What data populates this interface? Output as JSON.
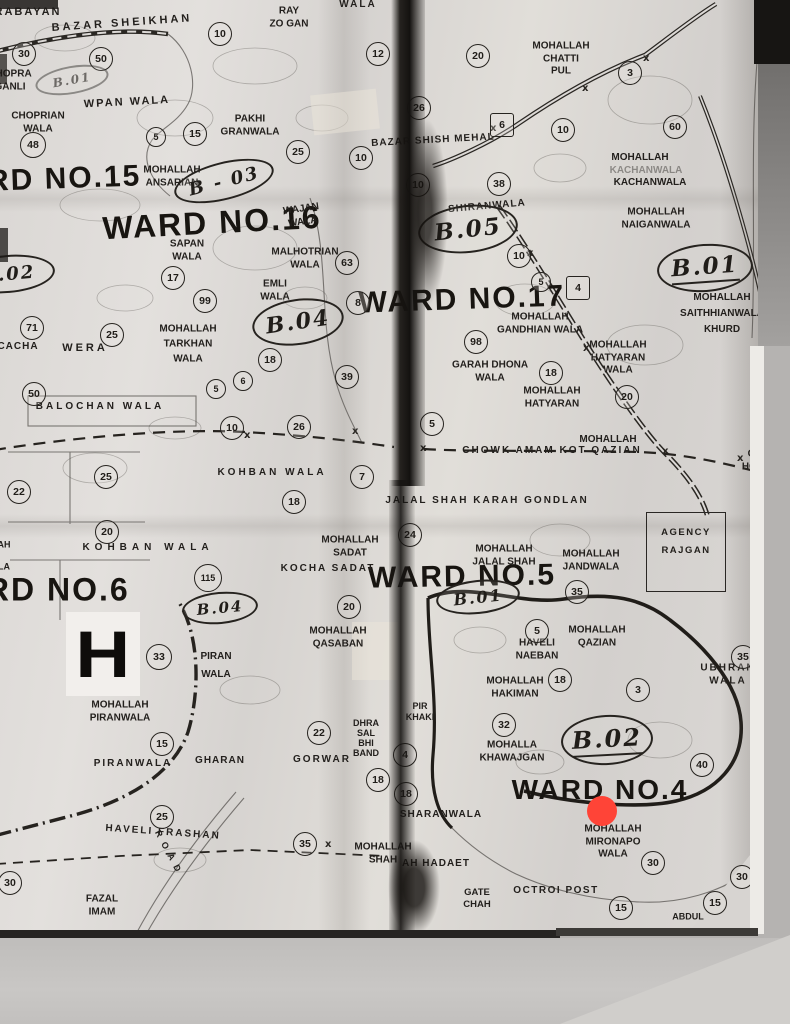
{
  "map": {
    "colors": {
      "ink": "#221f1c",
      "paper": "#dcd9d6",
      "red_dot": "#ff4437",
      "strip": "#141210"
    },
    "ward_titles": [
      {
        "text": "WARD NO.15",
        "x": 38,
        "y": 180,
        "size": 30,
        "rot": -2
      },
      {
        "text": "WARD NO.16",
        "x": 212,
        "y": 223,
        "size": 32,
        "rot": -3
      },
      {
        "text": "WARD NO.17",
        "x": 462,
        "y": 300,
        "size": 30,
        "rot": -2
      },
      {
        "text": "WARD NO.6",
        "x": 30,
        "y": 590,
        "size": 32,
        "rot": 0
      },
      {
        "text": "WARD NO.5",
        "x": 462,
        "y": 577,
        "size": 30,
        "rot": -1
      },
      {
        "text": "WARD NO.4",
        "x": 600,
        "y": 790,
        "size": 28,
        "rot": 0
      }
    ],
    "block_codes": [
      {
        "text": "B - 03",
        "x": 224,
        "y": 181,
        "w": 98,
        "h": 34,
        "rot": -14
      },
      {
        "text": "B.02",
        "x": 8,
        "y": 274,
        "w": 90,
        "h": 34,
        "rot": -5
      },
      {
        "text": "B.04",
        "x": 298,
        "y": 322,
        "w": 88,
        "h": 42,
        "rot": -8
      },
      {
        "text": "B.05",
        "x": 468,
        "y": 229,
        "w": 96,
        "h": 44,
        "rot": -6
      },
      {
        "text": "B.01",
        "x": 705,
        "y": 268,
        "w": 92,
        "h": 44,
        "rot": -4,
        "ul": true
      },
      {
        "text": "B.01",
        "x": 478,
        "y": 597,
        "w": 80,
        "h": 30,
        "rot": -6
      },
      {
        "text": "B.04",
        "x": 220,
        "y": 608,
        "w": 72,
        "h": 28,
        "rot": -5
      },
      {
        "text": "B.02",
        "x": 607,
        "y": 740,
        "w": 88,
        "h": 46,
        "rot": -3,
        "ul": true
      },
      {
        "text": "B.01",
        "x": 72,
        "y": 80,
        "w": 70,
        "h": 24,
        "rot": -10,
        "faint": true
      }
    ],
    "number_circles": [
      {
        "n": "30",
        "x": 24,
        "y": 54
      },
      {
        "n": "50",
        "x": 101,
        "y": 59
      },
      {
        "n": "10",
        "x": 220,
        "y": 34
      },
      {
        "n": "12",
        "x": 378,
        "y": 54
      },
      {
        "n": "5",
        "x": 156,
        "y": 137,
        "d": 18
      },
      {
        "n": "15",
        "x": 195,
        "y": 134
      },
      {
        "n": "25",
        "x": 298,
        "y": 152
      },
      {
        "n": "10",
        "x": 361,
        "y": 158
      },
      {
        "n": "48",
        "x": 33,
        "y": 145,
        "d": 24
      },
      {
        "n": "20",
        "x": 478,
        "y": 56
      },
      {
        "n": "3",
        "x": 630,
        "y": 73
      },
      {
        "n": "26",
        "x": 419,
        "y": 108
      },
      {
        "n": "6",
        "x": 502,
        "y": 125,
        "shape": "square"
      },
      {
        "n": "10",
        "x": 563,
        "y": 130
      },
      {
        "n": "60",
        "x": 675,
        "y": 127
      },
      {
        "n": "10",
        "x": 418,
        "y": 185
      },
      {
        "n": "38",
        "x": 499,
        "y": 184
      },
      {
        "n": "17",
        "x": 173,
        "y": 278
      },
      {
        "n": "63",
        "x": 347,
        "y": 263
      },
      {
        "n": "99",
        "x": 205,
        "y": 301
      },
      {
        "n": "8",
        "x": 358,
        "y": 303
      },
      {
        "n": "71",
        "x": 32,
        "y": 328
      },
      {
        "n": "25",
        "x": 112,
        "y": 335
      },
      {
        "n": "18",
        "x": 270,
        "y": 360
      },
      {
        "n": "6",
        "x": 243,
        "y": 381,
        "d": 18
      },
      {
        "n": "5",
        "x": 216,
        "y": 389,
        "d": 18
      },
      {
        "n": "39",
        "x": 347,
        "y": 377
      },
      {
        "n": "50",
        "x": 34,
        "y": 394
      },
      {
        "n": "10",
        "x": 519,
        "y": 256
      },
      {
        "n": "5",
        "x": 541,
        "y": 282,
        "d": 18
      },
      {
        "n": "4",
        "x": 578,
        "y": 288,
        "shape": "square"
      },
      {
        "n": "98",
        "x": 476,
        "y": 342
      },
      {
        "n": "18",
        "x": 551,
        "y": 373
      },
      {
        "n": "20",
        "x": 627,
        "y": 397
      },
      {
        "n": "10",
        "x": 232,
        "y": 428
      },
      {
        "n": "26",
        "x": 299,
        "y": 427
      },
      {
        "n": "25",
        "x": 106,
        "y": 477
      },
      {
        "n": "22",
        "x": 19,
        "y": 492
      },
      {
        "n": "7",
        "x": 362,
        "y": 477
      },
      {
        "n": "18",
        "x": 294,
        "y": 502
      },
      {
        "n": "20",
        "x": 107,
        "y": 532
      },
      {
        "n": "115",
        "x": 208,
        "y": 578,
        "d": 26
      },
      {
        "n": "5",
        "x": 432,
        "y": 424
      },
      {
        "n": "24",
        "x": 410,
        "y": 535
      },
      {
        "n": "35",
        "x": 577,
        "y": 592
      },
      {
        "n": "20",
        "x": 349,
        "y": 607
      },
      {
        "n": "33",
        "x": 159,
        "y": 657,
        "d": 24
      },
      {
        "n": "22",
        "x": 319,
        "y": 733
      },
      {
        "n": "15",
        "x": 162,
        "y": 744
      },
      {
        "n": "18",
        "x": 378,
        "y": 780
      },
      {
        "n": "5",
        "x": 537,
        "y": 631
      },
      {
        "n": "18",
        "x": 560,
        "y": 680
      },
      {
        "n": "3",
        "x": 638,
        "y": 690
      },
      {
        "n": "35",
        "x": 743,
        "y": 657
      },
      {
        "n": "32",
        "x": 504,
        "y": 725
      },
      {
        "n": "40",
        "x": 702,
        "y": 765
      },
      {
        "n": "4",
        "x": 405,
        "y": 755
      },
      {
        "n": "18",
        "x": 406,
        "y": 794
      },
      {
        "n": "25",
        "x": 162,
        "y": 817
      },
      {
        "n": "35",
        "x": 305,
        "y": 844
      },
      {
        "n": "30",
        "x": 10,
        "y": 883
      },
      {
        "n": "30",
        "x": 653,
        "y": 863
      },
      {
        "n": "30",
        "x": 742,
        "y": 877
      },
      {
        "n": "15",
        "x": 621,
        "y": 908
      },
      {
        "n": "15",
        "x": 715,
        "y": 903
      }
    ],
    "labels": [
      {
        "text": "RABAYAN",
        "x": 28,
        "y": 13,
        "size": 11,
        "sp": 2
      },
      {
        "text": "BAZAR SHEIKHAN",
        "x": 122,
        "y": 24,
        "size": 11,
        "sp": 3,
        "rot": -4
      },
      {
        "text": "RAY\nZO GAN",
        "x": 289,
        "y": 18
      },
      {
        "text": "WALA",
        "x": 358,
        "y": 5,
        "sp": 2
      },
      {
        "text": "CHOPRA\nGANLI",
        "x": 10,
        "y": 81
      },
      {
        "text": "WPAN WALA",
        "x": 127,
        "y": 103,
        "size": 11,
        "sp": 2,
        "rot": -3
      },
      {
        "text": "CHOPRIAN\nWALA",
        "x": 38,
        "y": 123
      },
      {
        "text": "PAKHI\nGRANWALA",
        "x": 250,
        "y": 126
      },
      {
        "text": "MOHALLAH\nANSARIAN",
        "x": 172,
        "y": 177
      },
      {
        "text": "MOHALLAH\nCHATTI\nPUL",
        "x": 561,
        "y": 59
      },
      {
        "text": "BAZAR SHISH MEHAL",
        "x": 433,
        "y": 141,
        "sp": 1,
        "rot": -3
      },
      {
        "text": "MOHALLAH",
        "x": 640,
        "y": 158
      },
      {
        "text": "KACHANWALA",
        "x": 646,
        "y": 171,
        "faded": true
      },
      {
        "text": "KACHANWALA",
        "x": 650,
        "y": 183
      },
      {
        "text": "MOHALLAH\nNAIGANWALA",
        "x": 656,
        "y": 219
      },
      {
        "text": "SHIRANWALA",
        "x": 487,
        "y": 207,
        "rot": -5,
        "sp": 1
      },
      {
        "text": "WAJAN\nWALA",
        "x": 302,
        "y": 216,
        "rot": -8
      },
      {
        "text": "SAPAN\nWALA",
        "x": 187,
        "y": 251
      },
      {
        "text": "MALHOTRIAN\nWALA",
        "x": 305,
        "y": 259
      },
      {
        "text": "EMLI\nWALA",
        "x": 275,
        "y": 291
      },
      {
        "text": "MOHALLAH\nTARKHAN\nWALA",
        "x": 188,
        "y": 344,
        "lh": 15
      },
      {
        "text": "CACHA",
        "x": 18,
        "y": 347,
        "sp": 1
      },
      {
        "text": "WERA",
        "x": 85,
        "y": 349,
        "size": 11,
        "sp": 3
      },
      {
        "text": "BALOCHAN WALA",
        "x": 100,
        "y": 407,
        "sp": 3
      },
      {
        "text": "MOHALLAH\nGANDHIAN WALA",
        "x": 540,
        "y": 324
      },
      {
        "text": "GARAH DHONA\nWALA",
        "x": 490,
        "y": 372
      },
      {
        "text": "MOHALLAH\nHATYARAN\nWALA",
        "x": 618,
        "y": 358
      },
      {
        "text": "MOHALLAH\nHATYARAN",
        "x": 552,
        "y": 398
      },
      {
        "text": "MOHALLAH\nSAITHHIANWALA\nKHURD",
        "x": 722,
        "y": 314,
        "lh": 16
      },
      {
        "text": "KOHBAN WALA",
        "x": 272,
        "y": 473,
        "sp": 3
      },
      {
        "text": "KOHBAN WALA",
        "x": 148,
        "y": 548,
        "sp": 5
      },
      {
        "text": "MOHALLAH\nSADAT",
        "x": 350,
        "y": 547
      },
      {
        "text": "KOCHA SADAT",
        "x": 328,
        "y": 569,
        "sp": 2
      },
      {
        "text": "MOHALLAH",
        "x": 608,
        "y": 440
      },
      {
        "text": "CHOWK AMAM KOT QAZIAN",
        "x": 552,
        "y": 451,
        "sp": 2
      },
      {
        "text": "JALAL SHAH KARAH GONDLAN",
        "x": 487,
        "y": 501,
        "sp": 2
      },
      {
        "text": "MOHALLAH\nJALAL SHAH",
        "x": 504,
        "y": 556
      },
      {
        "text": "MOHALLAH\nJANDWALA",
        "x": 591,
        "y": 561
      },
      {
        "text": "CIV\nHOSP",
        "x": 756,
        "y": 461
      },
      {
        "text": "UBHRAN WALA",
        "x": 728,
        "y": 675,
        "sp": 2
      },
      {
        "text": "MOHALLAH\nQASABAN",
        "x": 338,
        "y": 638
      },
      {
        "text": "PIRAN\nWALA",
        "x": 216,
        "y": 666,
        "lh": 18
      },
      {
        "text": "MOHALLAH\nPIRANWALA",
        "x": 120,
        "y": 712
      },
      {
        "text": "PIRANWALA",
        "x": 133,
        "y": 764,
        "sp": 2
      },
      {
        "text": "GHARAN",
        "x": 220,
        "y": 761,
        "sp": 1
      },
      {
        "text": "GORWAR",
        "x": 322,
        "y": 760,
        "sp": 2
      },
      {
        "text": "DHRA\nSAL\nBHI\nBAND",
        "x": 366,
        "y": 738,
        "size": 9,
        "lh": 10
      },
      {
        "text": "HAVELI\nNAEBAN",
        "x": 537,
        "y": 650
      },
      {
        "text": "MOHALLAH\nQAZIAN",
        "x": 597,
        "y": 637
      },
      {
        "text": "MOHALLAH\nHAKIMAN",
        "x": 515,
        "y": 688
      },
      {
        "text": "PIR\nKHAKI",
        "x": 420,
        "y": 712,
        "size": 9
      },
      {
        "text": "MOHALLA\nKHAWAJGAN",
        "x": 512,
        "y": 752
      },
      {
        "text": "HAVELI FRASHAN",
        "x": 163,
        "y": 833,
        "sp": 2,
        "rot": 4
      },
      {
        "text": "FAZAL\nIMAM",
        "x": 102,
        "y": 906
      },
      {
        "text": "R O A D",
        "x": 168,
        "y": 852,
        "size": 9,
        "sp": 2,
        "rot": 62
      },
      {
        "text": "MOHALLAH\nSHAH",
        "x": 383,
        "y": 854
      },
      {
        "text": "AH HADAET",
        "x": 436,
        "y": 864,
        "sp": 1
      },
      {
        "text": "SHARANWALA",
        "x": 441,
        "y": 815,
        "sp": 1
      },
      {
        "text": "GATE\nCHAH",
        "x": 477,
        "y": 899,
        "size": 9.5
      },
      {
        "text": "OCTROI POST",
        "x": 556,
        "y": 891,
        "sp": 1.5
      },
      {
        "text": "MOHALLAH\nMIRONAPO\nWALA",
        "x": 613,
        "y": 842
      },
      {
        "text": "ABDUL",
        "x": 688,
        "y": 917,
        "size": 9
      },
      {
        "text": "AH",
        "x": 4,
        "y": 545,
        "size": 9
      },
      {
        "text": "LA",
        "x": 4,
        "y": 567,
        "size": 9
      }
    ],
    "special": {
      "hospital": {
        "letter": "H"
      },
      "agency": {
        "lines": [
          "AGENCY",
          "RAJGAN"
        ]
      },
      "red_dot": {
        "x": 602,
        "y": 811,
        "diameter": 30,
        "color": "#ff4437"
      }
    }
  }
}
